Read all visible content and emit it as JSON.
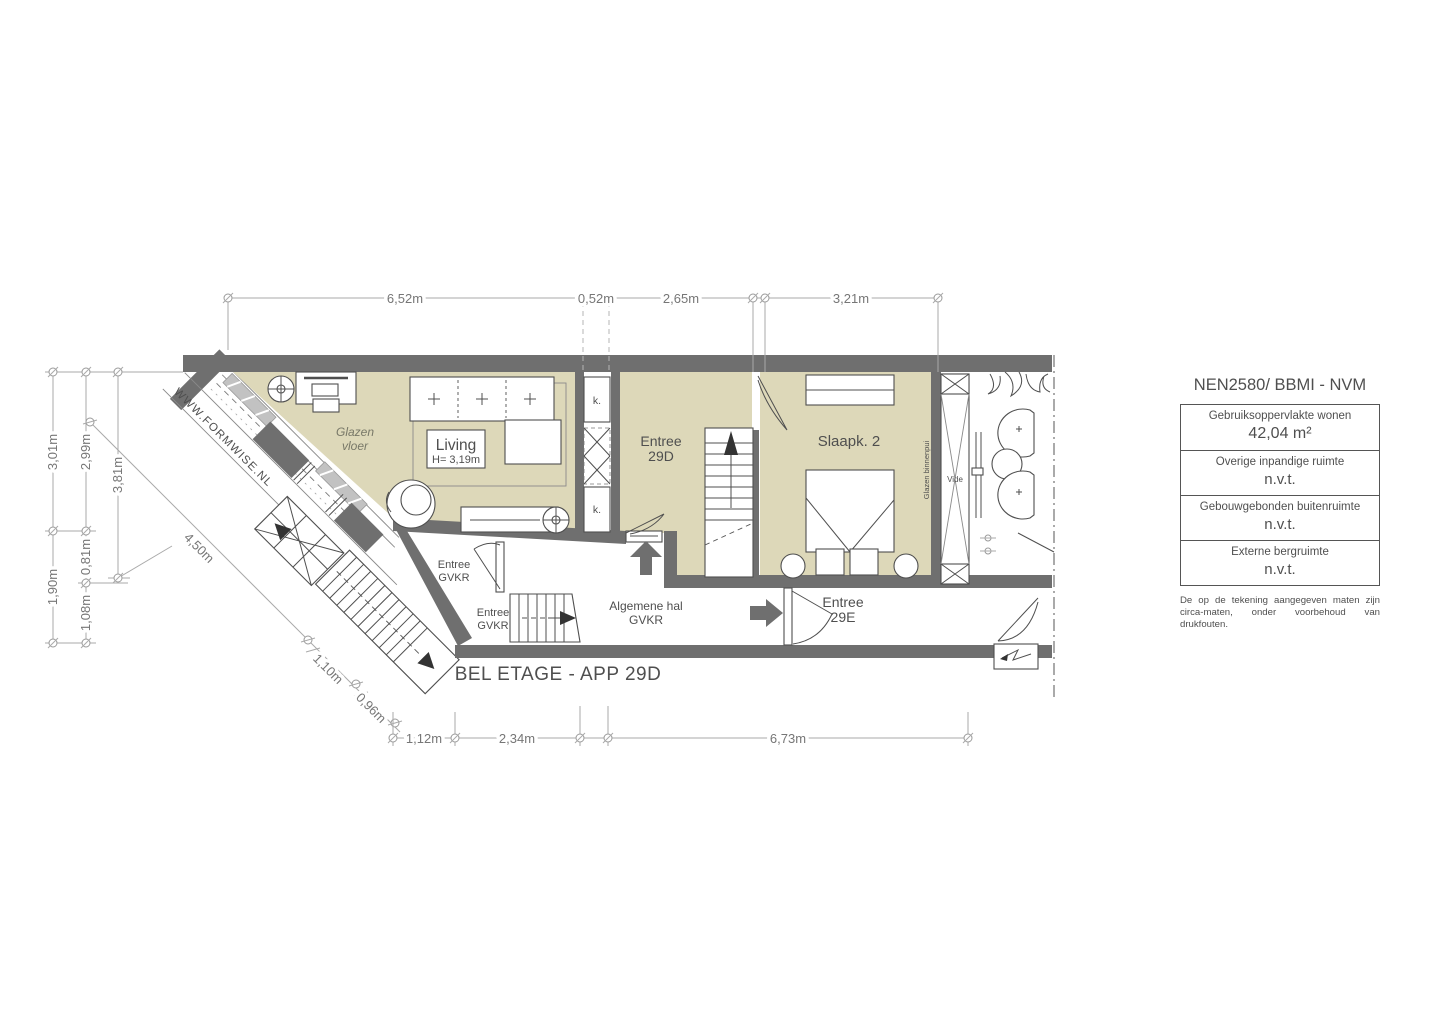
{
  "plan": {
    "title": "BEL ETAGE - APP 29D",
    "watermark": "WWW.FORMWISE.NL",
    "labels": {
      "glazen_vloer_1": "Glazen",
      "glazen_vloer_2": "vloer",
      "living": "Living",
      "living_height": "H= 3,19m",
      "entree29d_1": "Entree",
      "entree29d_2": "29D",
      "slaapk2": "Slaapk. 2",
      "gvkr_entree": "Entree",
      "gvkr": "GVKR",
      "hal_1": "Algemene hal",
      "hal_2": "GVKR",
      "entree29e_1": "Entree",
      "entree29e_2": "29E",
      "closet": "k.",
      "vide": "Vide",
      "glazen_binnenpui": "Glazen binnenpui"
    },
    "dimensions": {
      "top": [
        "6,52m",
        "0,52m",
        "2,65m",
        "3,21m"
      ],
      "left": [
        "3,01m",
        "2,99m",
        "3,81m",
        "1,90m",
        "0,81m",
        "1,08m"
      ],
      "diagonal": [
        "4,50m",
        "1,10m",
        "0,96m"
      ],
      "bottom": [
        "1,12m",
        "2,34m",
        "6,73m"
      ]
    }
  },
  "panel": {
    "title": "NEN2580/ BBMI - NVM",
    "rows": [
      {
        "label": "Gebruiksoppervlakte wonen",
        "value": "42,04 m²"
      },
      {
        "label": "Overige inpandige ruimte",
        "value": "n.v.t."
      },
      {
        "label": "Gebouwgebonden buitenruimte",
        "value": "n.v.t."
      },
      {
        "label": "Externe bergruimte",
        "value": "n.v.t."
      }
    ],
    "note": "De op de tekening aangegeven maten zijn circa-maten, onder voorbehoud van drukfouten."
  }
}
